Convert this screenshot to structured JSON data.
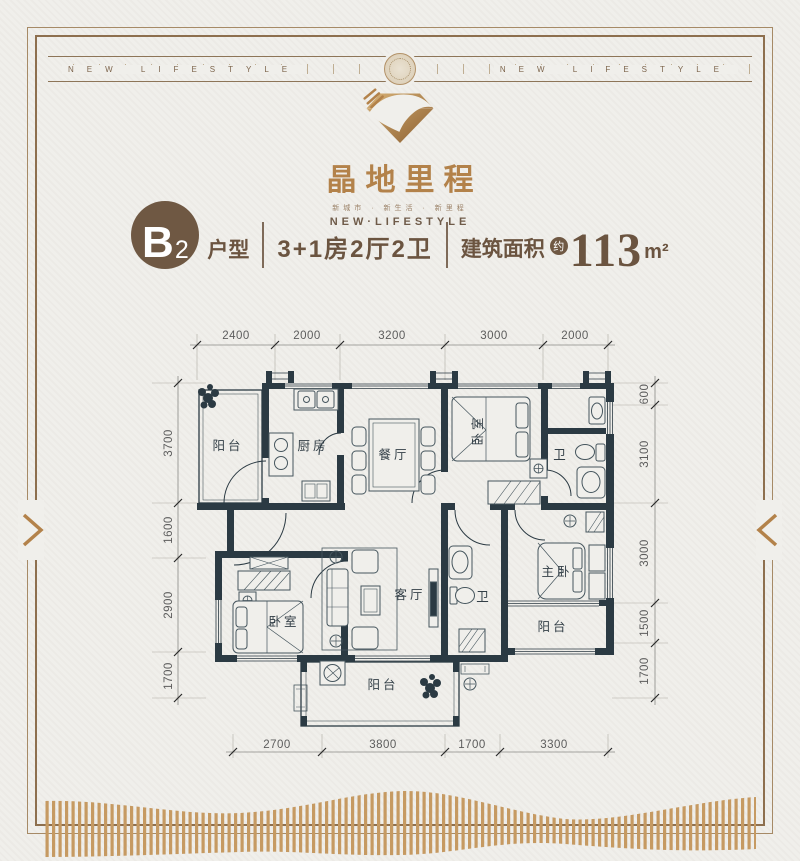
{
  "band": {
    "text": "NEW LIFESTYLE"
  },
  "logo": {
    "brand": "晶地里程",
    "tagline": "新城市 · 新生活 · 新里程",
    "subtitle": "NEW·LIFESTYLE"
  },
  "unit_header": {
    "badge_main": "B",
    "badge_sub": "2",
    "type_label": "户型",
    "layout_text": "3+1房2厅2卫",
    "area_label": "建筑面积",
    "area_approx": "约",
    "area_value": "113",
    "area_unit": "m²"
  },
  "floor_plan": {
    "rooms": {
      "balcony_top": "阳台",
      "kitchen": "厨房",
      "dining": "餐厅",
      "bedroom_top": "卧室",
      "bath_top": "卫",
      "bedroom_left": "卧室",
      "living": "客厅",
      "bath_mid": "卫",
      "master": "主卧",
      "balcony_right": "阳台",
      "balcony_bottom": "阳台"
    },
    "dimensions": {
      "top": [
        "2400",
        "2000",
        "3200",
        "3000",
        "2000"
      ],
      "bottom": [
        "2700",
        "3800",
        "1700",
        "3300"
      ],
      "left": [
        "3700",
        "1600",
        "2900",
        "1700"
      ],
      "right": [
        "600",
        "3100",
        "3000",
        "1500",
        "1700"
      ]
    }
  },
  "colors": {
    "wall": "#2b3a43",
    "gold": "#b3824a",
    "brown": "#6b5440",
    "frame": "#8d6f4e",
    "paper": "#f0efeb"
  }
}
